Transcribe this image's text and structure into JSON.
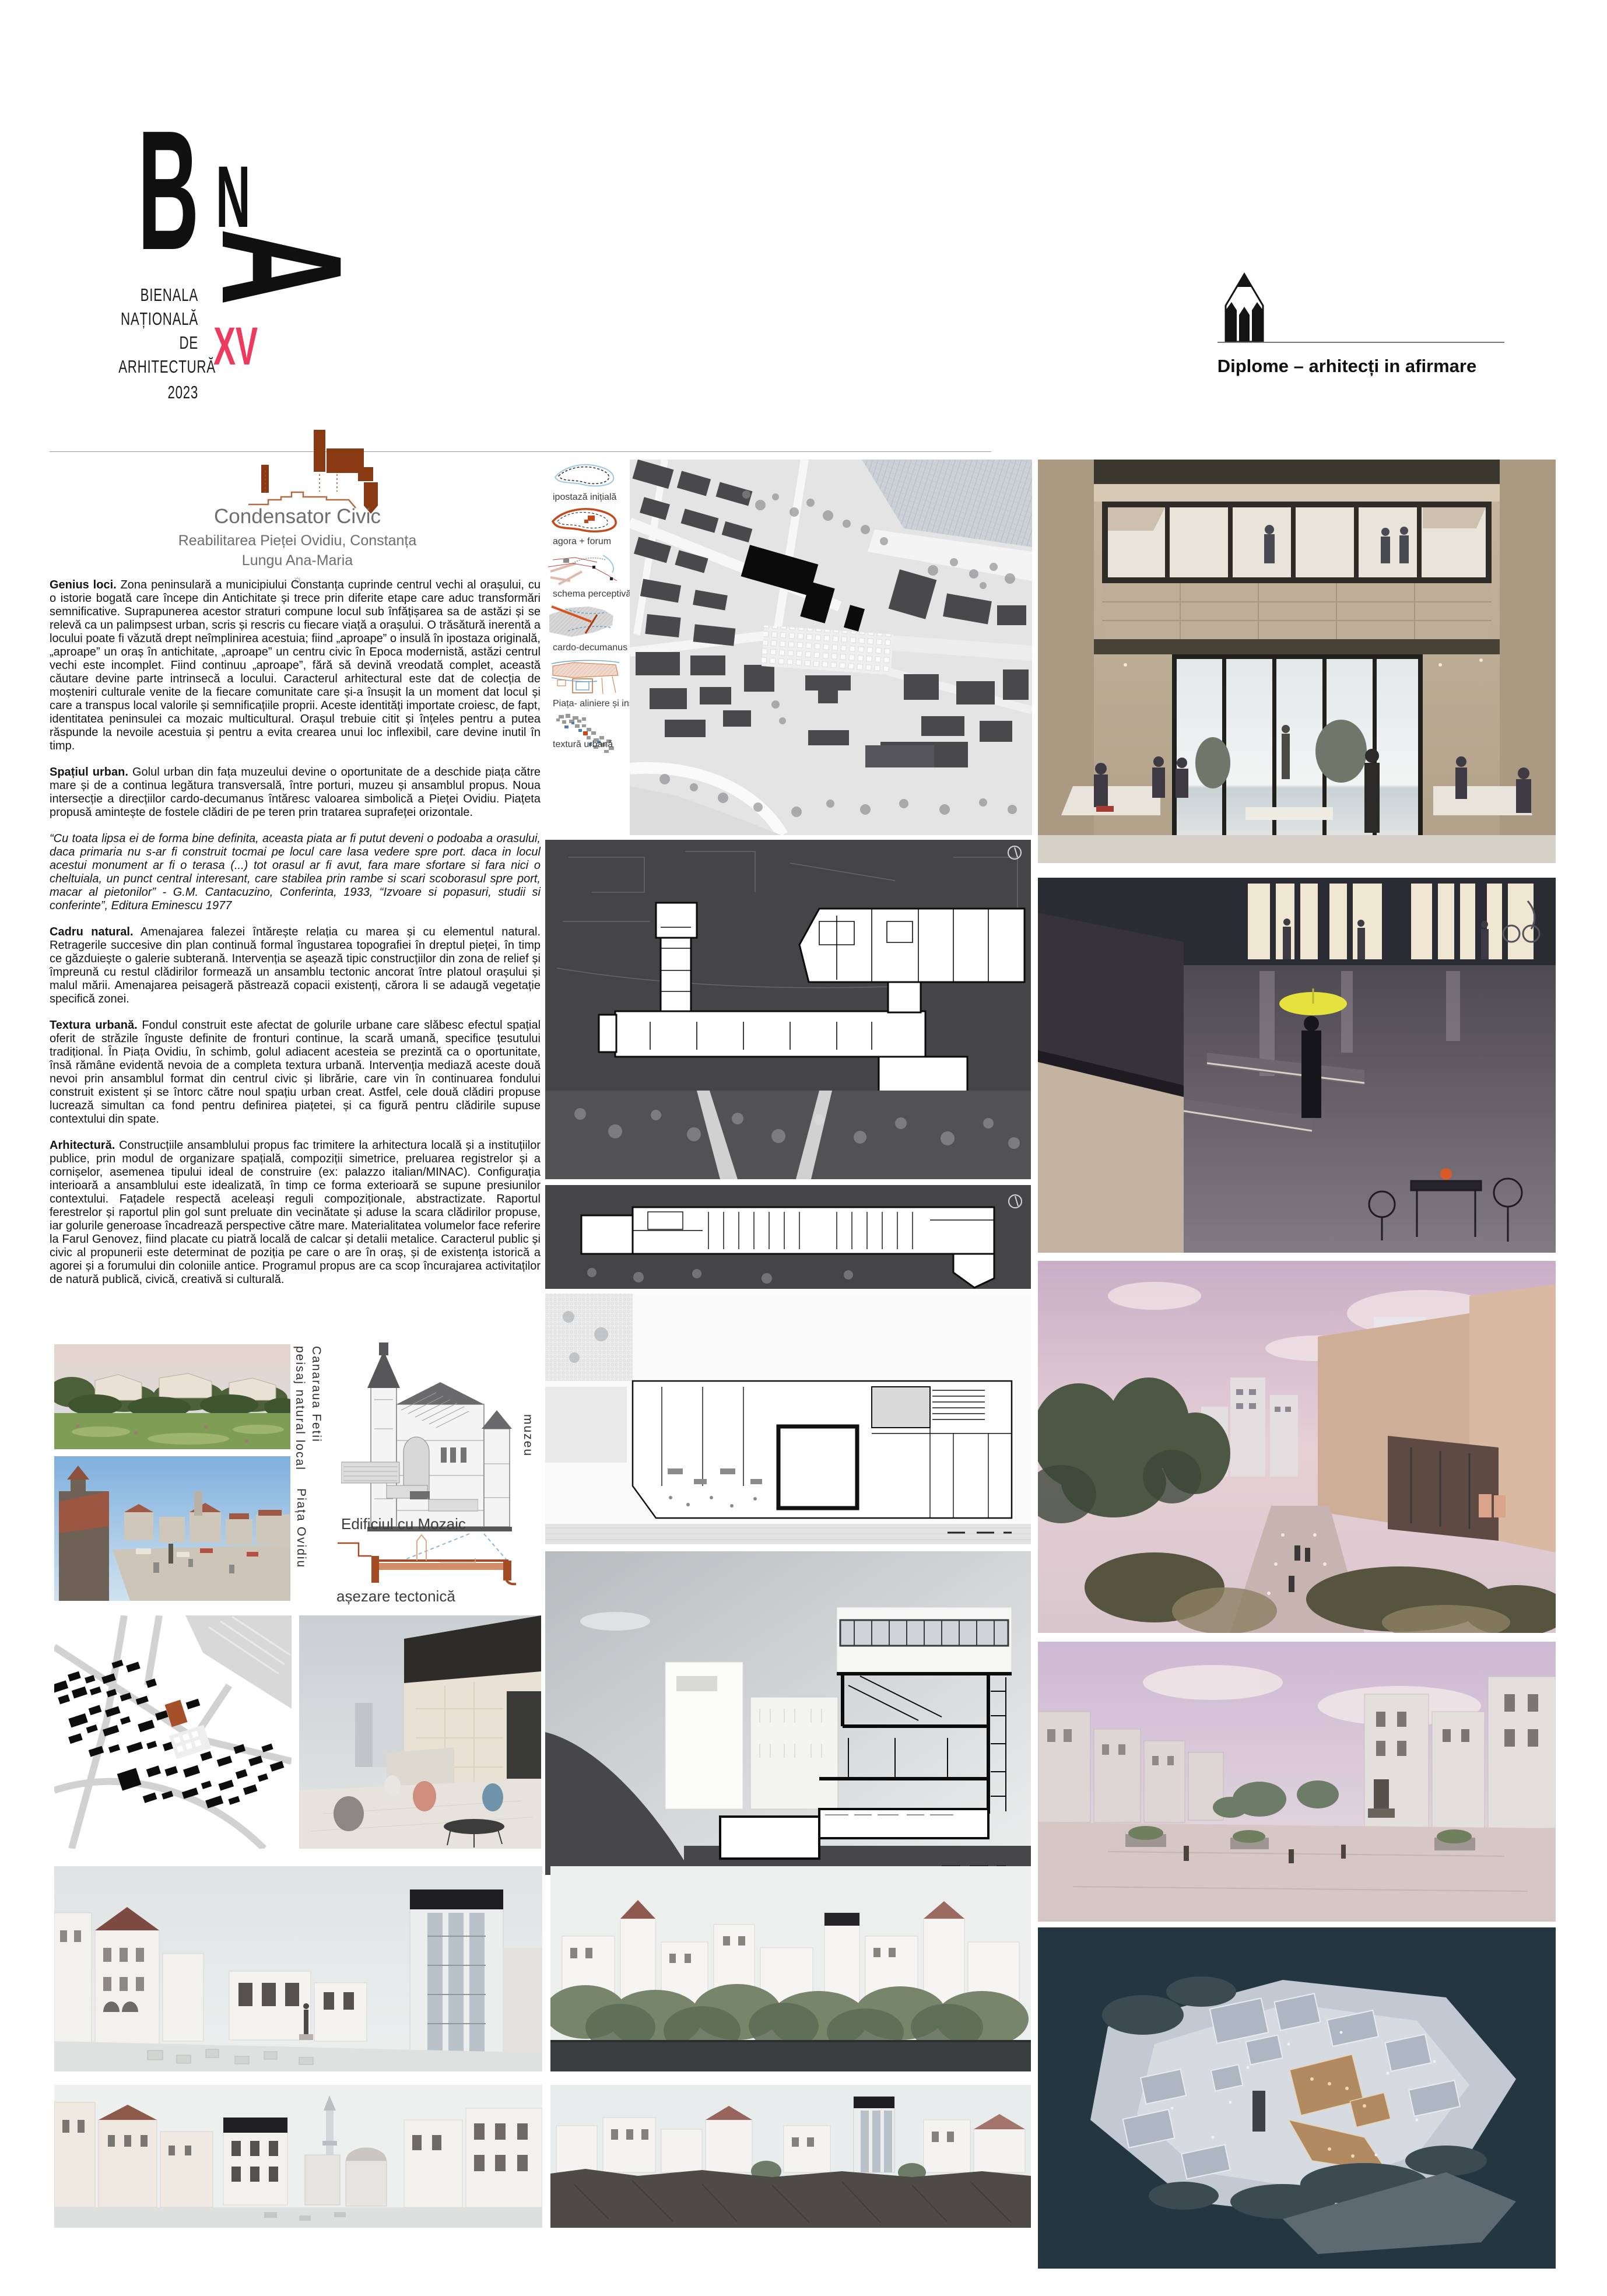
{
  "header": {
    "logo": {
      "letter_b": "B",
      "letter_n": "N",
      "letter_a": "A",
      "line1": "BIENALA",
      "line2": "NAȚIONALĂ",
      "line3": "DE",
      "line4": "ARHITECTURĂ",
      "year": "2023",
      "edition": "XV"
    },
    "program_label": "Diplome – arhitecți in afirmare"
  },
  "project": {
    "title": "Condensator Civic",
    "subtitle": "Reabilitarea Pieței Ovidiu, Constanța",
    "author": "Lungu Ana-Maria",
    "sun_icon": "☼"
  },
  "essay": {
    "sections": [
      {
        "lead": "Genius loci.",
        "text": "Zona peninsulară a municipiului Constanța cuprinde centrul vechi al orașului, cu o istorie bogată care începe din Antichitate și trece prin diferite etape care aduc transformări semnificative. Suprapunerea acestor straturi compune locul sub înfățișarea sa de astăzi și se relevă ca un palimpsest urban, scris și rescris cu fiecare viață a orașului. O trăsătură inerentă a locului poate fi văzută drept neîmplinirea acestuia; fiind „aproape” o insulă în ipostaza originală, „aproape” un oraș în antichitate, „aproape” un centru civic în Epoca modernistă, astăzi centrul vechi este incomplet. Fiind continuu „aproape”, fără să devină vreodată complet, această căutare devine parte intrinsecă a locului. Caracterul arhitectural este dat de colecția de moșteniri culturale venite de la fiecare comunitate care și-a însușit la un moment dat locul și care a transpus local valorile și semnificațiile proprii. Aceste identități importate croiesc, de fapt, identitatea peninsulei ca mozaic multicultural. Orașul trebuie citit și înțeles pentru a putea răspunde la nevoile acestuia și pentru a evita crearea unui loc inflexibil, care devine inutil în timp."
      },
      {
        "lead": "Spațiul urban.",
        "text": "Golul urban din fața muzeului devine o oportunitate de a deschide piața către mare și de a continua legătura transversală, între porturi, muzeu și ansamblul propus. Noua intersecție a direcțiilor cardo-decumanus întăresc valoarea simbolică a Pieței Ovidiu. Piațeta propusă amintește de fostele clădiri de pe teren prin tratarea suprafeței orizontale."
      },
      {
        "lead": "",
        "text": "“Cu toata lipsa ei de forma bine definita, aceasta piata ar fi putut deveni o podoaba a orasului, daca primaria nu s-ar fi construit tocmai pe locul care lasa vedere spre port. daca in locul acestui monument ar fi o terasa (...) tot orasul ar fi avut, fara mare sfortare si fara nici o cheltuiala, un punct central interesant, care stabilea prin rambe si scari scoborasul spre port, macar al pietonilor” - G.M. Cantacuzino, Conferinta, 1933, “Izvoare si popasuri, studii si conferinte”, Editura Eminescu 1977"
      },
      {
        "lead": "Cadru natural.",
        "text": "Amenajarea falezei întărește relația cu marea și cu elementul natural. Retragerile succesive din plan continuă formal îngustarea topografiei în dreptul pieței, în timp ce găzduiește o galerie subterană. Intervenția se așează tipic construcțiilor din zona de relief și împreună cu restul clădirilor formează un ansamblu tectonic ancorat între platoul orașului și malul mării. Amenajarea peisageră păstrează copacii existenți, cărora li se adaugă vegetație specifică zonei."
      },
      {
        "lead": "Textura urbană.",
        "text": "Fondul construit este afectat de golurile urbane care slăbesc efectul spațial oferit de străzile înguste definite de fronturi continue, la scară umană, specifice țesutului tradițional. În Piața Ovidiu, în schimb, golul adiacent acesteia se prezintă ca o oportunitate, însă rămâne evidentă nevoia de a completa textura urbană. Intervenția mediază aceste două nevoi prin ansamblul format din centrul civic și librărie, care vin în continuarea fondului construit existent și se întorc către noul spațiu urban creat. Astfel, cele două clădiri propuse lucrează simultan ca fond pentru definirea piațetei, și ca figură pentru clădirile supuse contextului din spate."
      },
      {
        "lead": "Arhitectură.",
        "text": "Construcțiile ansamblului propus fac trimitere la arhitectura locală și a instituțiilor publice, prin modul de organizare spațială, compoziții simetrice, preluarea registrelor și a cornișelor, asemenea tipului ideal de construire (ex: palazzo italian/MINAC). Configurația interioară a ansamblului este idealizată, în timp ce forma exterioară se supune presiunilor contextului. Fațadele respectă aceleași reguli compoziționale, abstractizate. Raportul ferestrelor și raportul plin gol sunt preluate din vecinătate și aduse la scara clădirilor propuse, iar golurile generoase încadrează perspective către mare. Materialitatea volumelor face referire la Farul Genovez, fiind placate cu piatră locală de calcar și detalii metalice. Caracterul public și civic al propunerii este determinat de poziția pe care o are în oraș, și de existența istorică a agorei și a forumului din coloniile antice. Programul propus are ca scop încurajarea activitaților de natură publică, civică, creativă si culturală."
      }
    ]
  },
  "diagrams": {
    "labels": [
      "ipostază inițială",
      "agora + forum",
      "schema perceptivă",
      "cardo-decumanus nou",
      "Piața- aliniere și insule",
      "textură urbană"
    ]
  },
  "captions": {
    "landscape_line1": "peisaj natural local",
    "landscape_line2": "Canaraua Fetii",
    "museum": "muzeu",
    "mosaic": "Edificiul cu Mozaic",
    "square": "Piața Ovidiu",
    "tectonic": "așezare tectonică"
  },
  "colors": {
    "accent_pink": "#ED3A5F",
    "sketch_brown": "#8a3a12",
    "aerial_background": "#243740"
  }
}
